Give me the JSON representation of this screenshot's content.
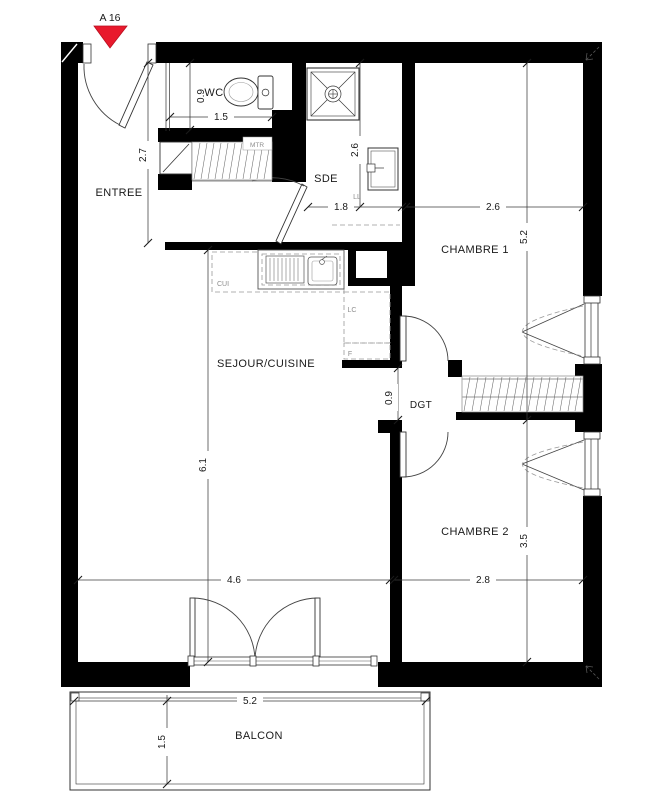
{
  "marker": {
    "label": "A 16",
    "color": "#e8192c"
  },
  "rooms": [
    {
      "id": "entree",
      "label": "ENTREE"
    },
    {
      "id": "wc",
      "label": "WC"
    },
    {
      "id": "sde",
      "label": "SDE"
    },
    {
      "id": "chambre1",
      "label": "CHAMBRE 1"
    },
    {
      "id": "sejour",
      "label": "SEJOUR/CUISINE"
    },
    {
      "id": "dgt",
      "label": "DGT"
    },
    {
      "id": "chambre2",
      "label": "CHAMBRE 2"
    },
    {
      "id": "balcon",
      "label": "BALCON"
    }
  ],
  "fixtures": [
    {
      "id": "meter-closet",
      "label": "MTR"
    },
    {
      "id": "washing-machine",
      "label": "LL"
    },
    {
      "id": "kitchen-counter",
      "label": "CUI"
    },
    {
      "id": "dishwasher",
      "label": "LC"
    },
    {
      "id": "fridge",
      "label": "F"
    }
  ],
  "dimensions": [
    {
      "id": "wc-width",
      "label": "1.5"
    },
    {
      "id": "wc-depth",
      "label": "0.9"
    },
    {
      "id": "entree-depth",
      "label": "2.7"
    },
    {
      "id": "sde-depth",
      "label": "2.6"
    },
    {
      "id": "sde-width",
      "label": "1.8"
    },
    {
      "id": "chambre1-width",
      "label": "2.6"
    },
    {
      "id": "chambre1-depth",
      "label": "5.2"
    },
    {
      "id": "sejour-depth",
      "label": "6.1"
    },
    {
      "id": "dgt-width",
      "label": "0.9"
    },
    {
      "id": "chambre2-depth",
      "label": "3.5"
    },
    {
      "id": "sejour-width",
      "label": "4.6"
    },
    {
      "id": "chambre2-width",
      "label": "2.8"
    },
    {
      "id": "balcon-width",
      "label": "5.2"
    },
    {
      "id": "balcon-depth",
      "label": "1.5"
    }
  ],
  "colors": {
    "wall": "#000000",
    "marker_red": "#e8192c",
    "line": "#3c3c3c",
    "text": "#1a1a1a",
    "muted": "#8d8d8d"
  }
}
